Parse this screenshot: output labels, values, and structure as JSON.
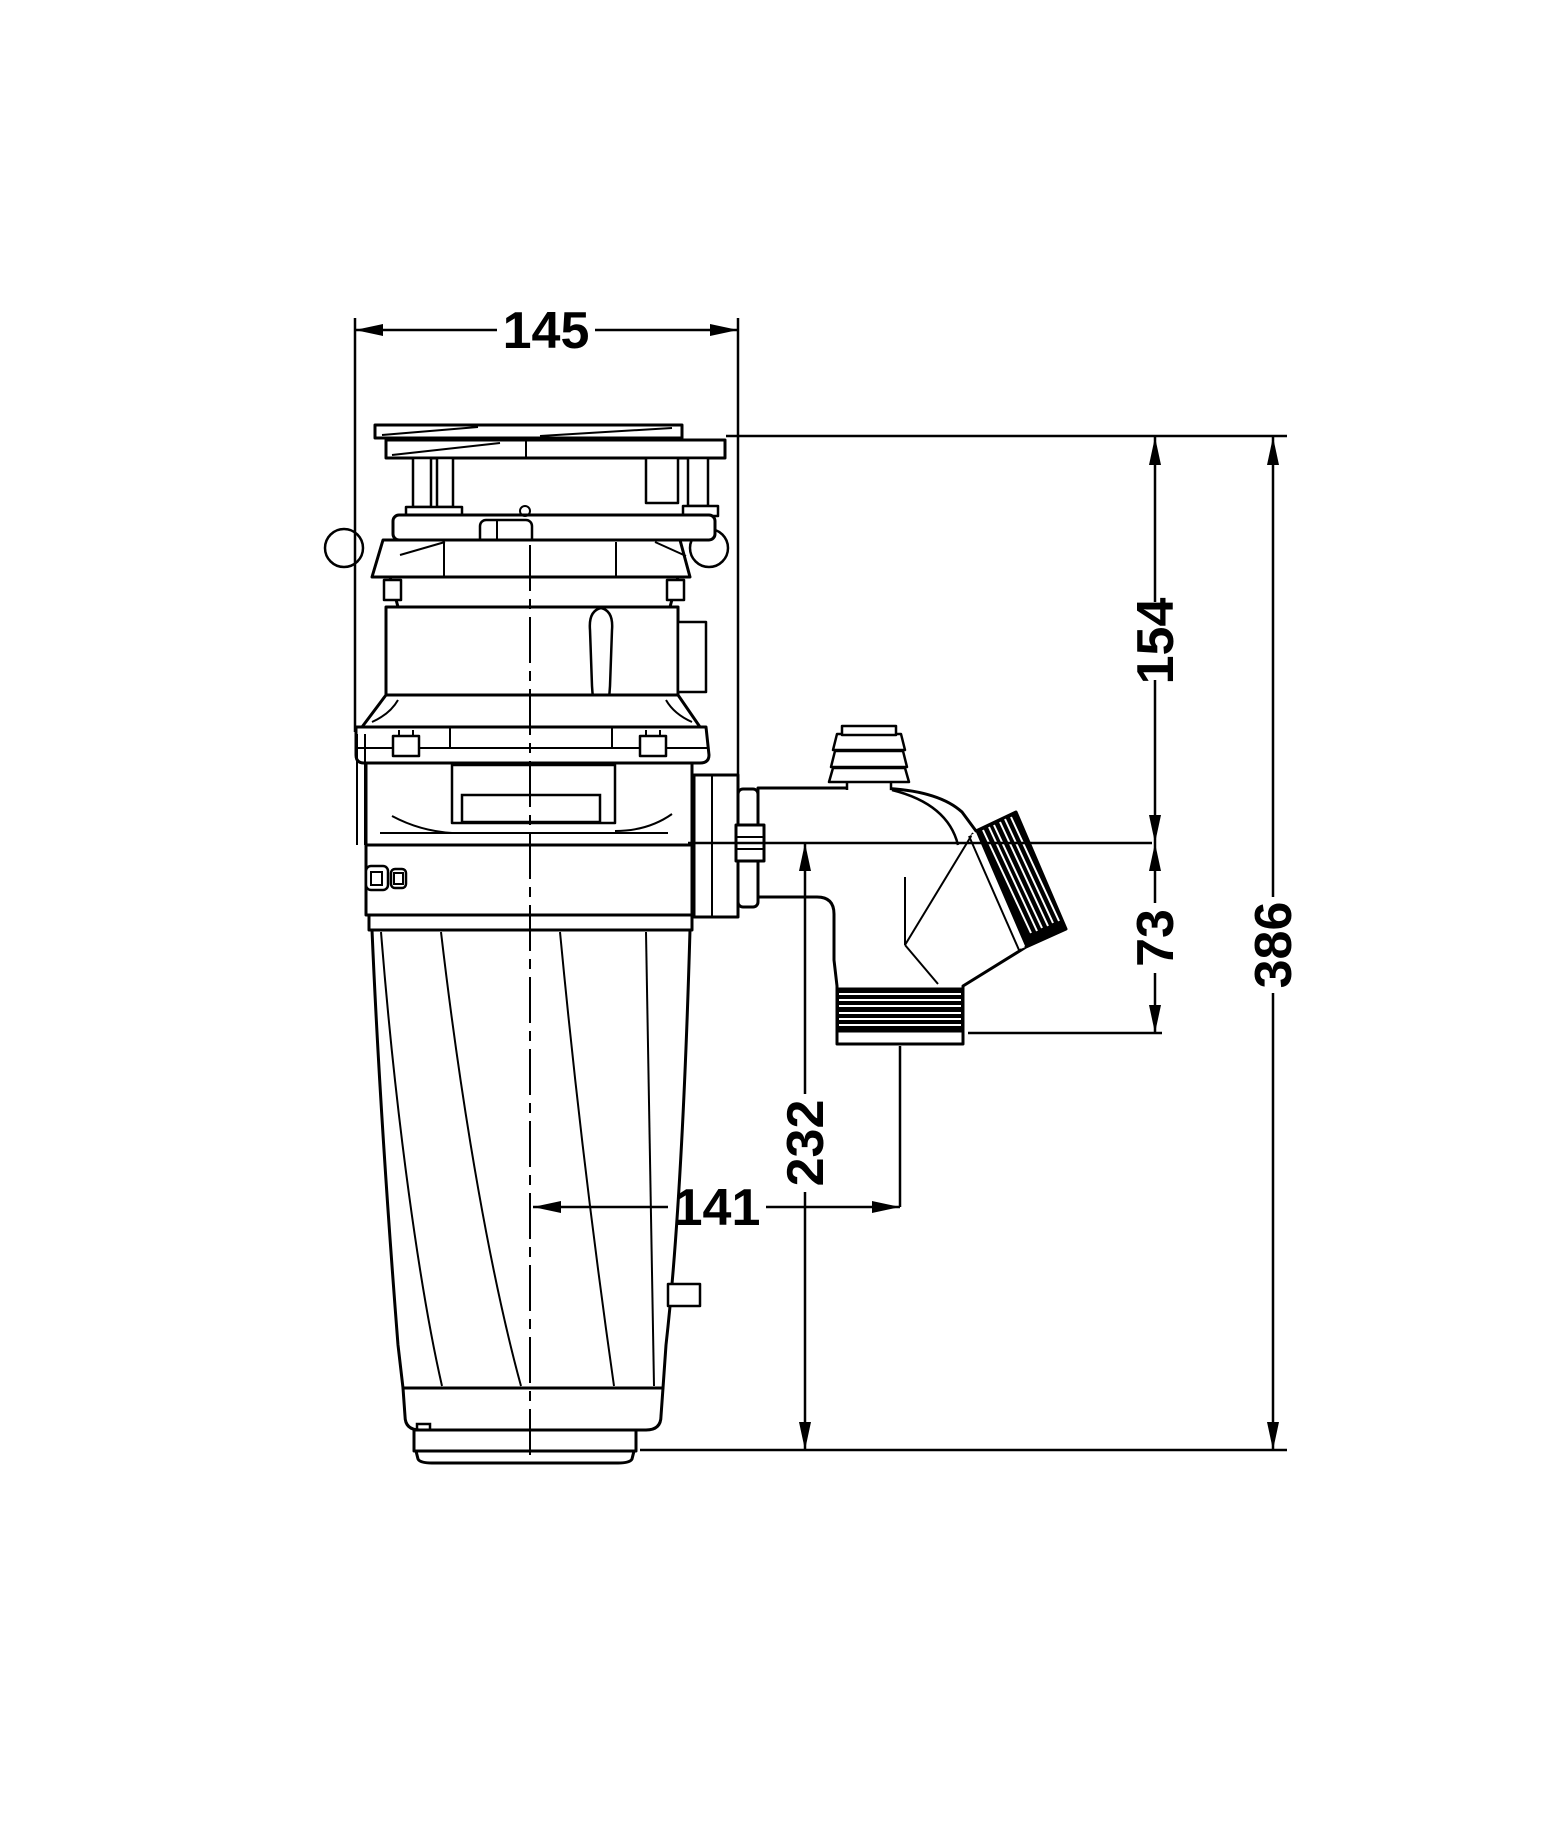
{
  "drawing": {
    "kind": "technical-dimension-drawing",
    "subject": "food-waste-disposer-side-elevation",
    "background_color": "#ffffff",
    "line_color": "#000000"
  },
  "dimensions": {
    "top_width": "145",
    "top_to_outlet_center": "154",
    "outlet_center_drop": "73",
    "overall_height": "386",
    "outlet_center_to_base": "232",
    "body_center_to_trap_center": "141"
  }
}
